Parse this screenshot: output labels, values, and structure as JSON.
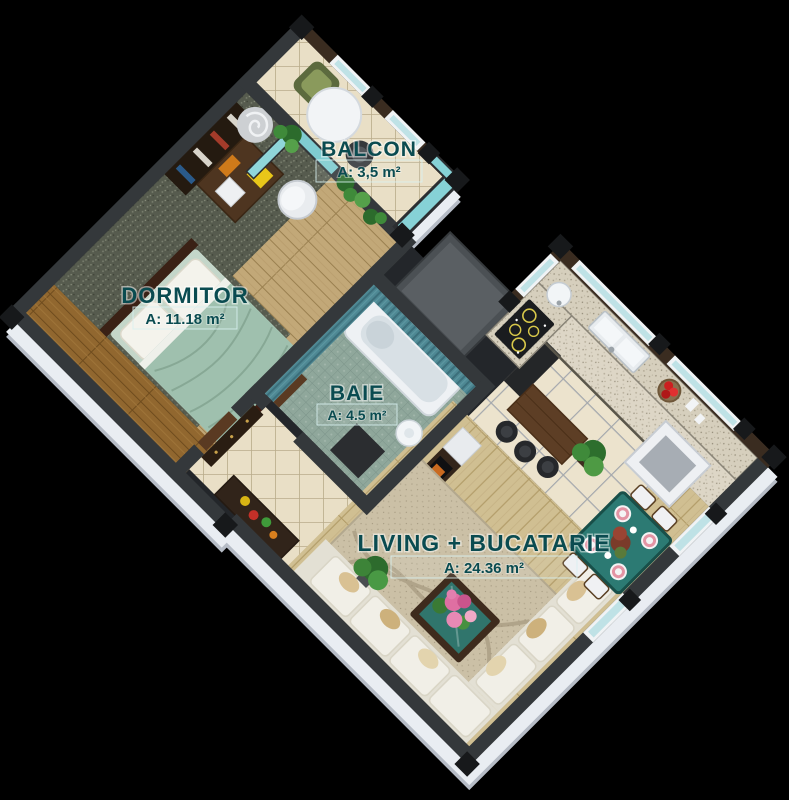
{
  "page_title": "Apartment 3D floor plan",
  "rooms": [
    {
      "id": "balcon",
      "name": "BALCON",
      "area": "A: 3,5 m²"
    },
    {
      "id": "dormitor",
      "name": "DORMITOR",
      "area": "A: 11.18 m²"
    },
    {
      "id": "baie",
      "name": "BAIE",
      "area": "A: 4.5 m²"
    },
    {
      "id": "living",
      "name": "LIVING + BUCATARIE",
      "area": "A: 24.36 m²"
    }
  ],
  "colors": {
    "background": "#000000",
    "label_text": "#0a4b50",
    "wall_dark": "#34383b",
    "wall_brown": "#3a2c20",
    "glass_teal": "#86d2d6",
    "exterior_face": "#e9edf2"
  }
}
